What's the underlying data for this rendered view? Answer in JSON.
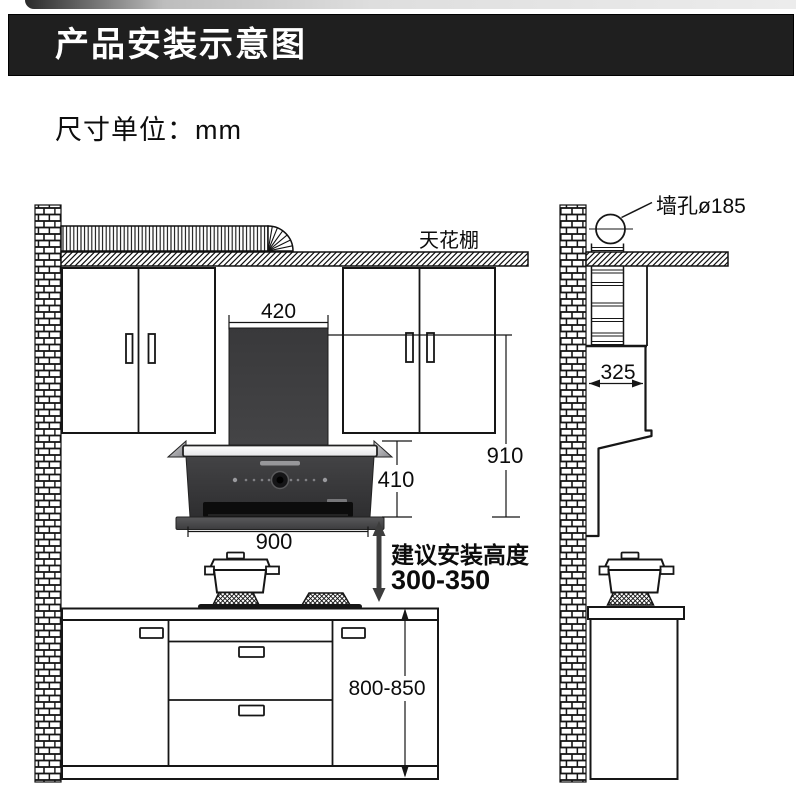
{
  "banner": {
    "title": "产品安装示意图"
  },
  "note": {
    "unit_label": "尺寸单位：mm"
  },
  "labels": {
    "ceiling": "天花棚",
    "wall_hole": "墙孔ø185",
    "install_height_title": "建议安装高度",
    "install_height_range": "300-350"
  },
  "dimensions": {
    "chimney_width": "420",
    "total_height": "910",
    "body_height": "410",
    "hood_width": "900",
    "side_clearance": "325",
    "counter_height": "800-850"
  },
  "colors": {
    "banner_bg": "#1f1f1f",
    "line": "#161616",
    "hood_body": "#353537",
    "hood_strip": "#f5f5f5"
  }
}
